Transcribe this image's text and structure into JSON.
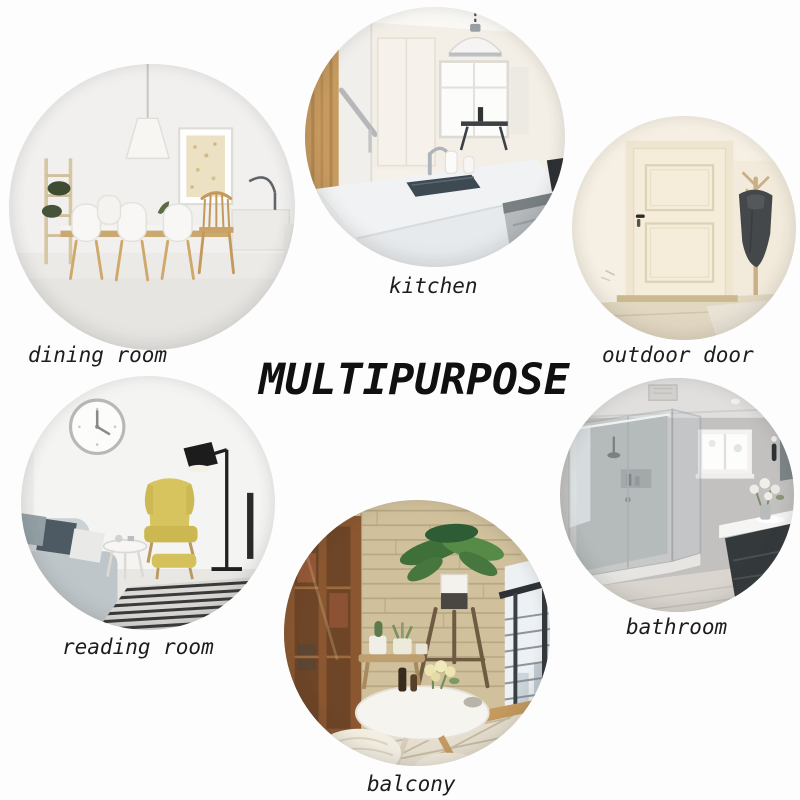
{
  "title": "MULTIPURPOSE",
  "circles": [
    {
      "id": "dining-room",
      "label": "dining room"
    },
    {
      "id": "kitchen",
      "label": "kitchen"
    },
    {
      "id": "outdoor-door",
      "label": "outdoor door"
    },
    {
      "id": "reading-room",
      "label": "reading room"
    },
    {
      "id": "balcony",
      "label": "balcony"
    },
    {
      "id": "bathroom",
      "label": "bathroom"
    }
  ],
  "palette": {
    "background": "#fdfdfd",
    "title_color": "#101010",
    "label_color": "#1d1d1d",
    "wood_accent": "#c89a62",
    "yellow_chair": "#d8c45e",
    "plant_green": "#47763f",
    "stone_wall": "#d0c09c",
    "coat_gray": "#45484a",
    "bathroom_gray": "#c2c1bf",
    "door_cream": "#f5edda"
  }
}
